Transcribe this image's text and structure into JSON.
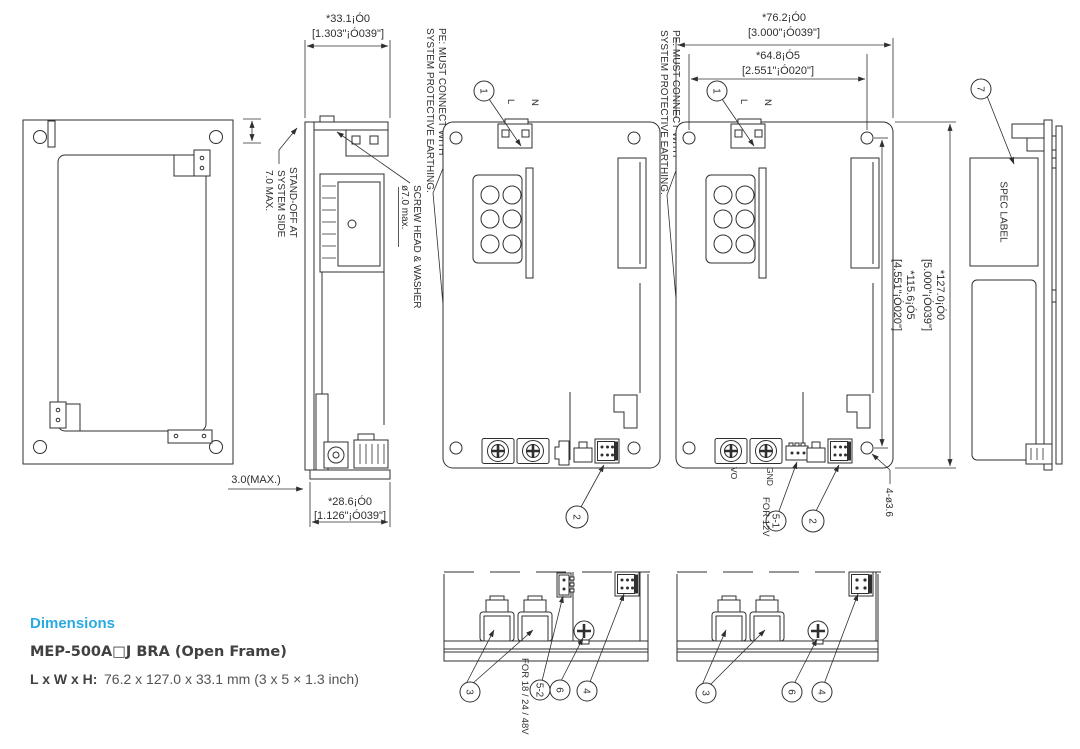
{
  "info": {
    "section_title": "Dimensions",
    "model_title": "MEP-500A□J BRA (Open Frame)",
    "lwh_label": "L x W x H:",
    "lwh_value": "76.2 x 127.0 x 33.1 mm (3 x 5 × 1.3 inch)"
  },
  "colors": {
    "accent": "#29abe2",
    "line": "#2f2f2f",
    "text_dark": "#414042"
  },
  "dims": {
    "depth_mm": "*33.1¡Ó0",
    "depth_in": "[1.303\"¡Ó039\"]",
    "width_mm": "*76.2¡Ó0",
    "width_in": "[3.000\"¡Ó039\"]",
    "hole_span_w_mm": "*64.8¡Ó5",
    "hole_span_w_in": "[2.551\"¡Ó020\"]",
    "height_mm": "*127.0¡Ó0",
    "height_in": "[5.000\"¡Ó039\"]",
    "hole_span_h_mm": "*115.6¡Ó5",
    "hole_span_h_in": "[4.551\"¡Ó020\"]",
    "base_mm": "*28.6¡Ó0",
    "base_in": "[1.126\"¡Ó039\"]",
    "pcb_clearance": "3.0(MAX.)",
    "mounting_holes": "4-ø3.6"
  },
  "notes": {
    "pe_line1": "PE: MUST CONNECT WITH",
    "pe_line2": "SYSTEM PROTECTIVE EARTHING.",
    "standoff_line1": "STAND-OFF AT",
    "standoff_line2": "SYSTEM SIDE",
    "standoff_line3": "7.0 MAX.",
    "screw_line1": "SCREW HEAD & WASHER",
    "screw_line2": "ø7.0 max.",
    "spec_label": "SPEC LABEL",
    "for_12v": "FOR 12V",
    "for_18_24_48v": "FOR 18 / 24 / 48V"
  },
  "terminals": {
    "l": "L",
    "n": "N",
    "vo": "VO",
    "gnd": "GND"
  },
  "callouts": {
    "n1": "1",
    "n2": "2",
    "n3": "3",
    "n4": "4",
    "n5_1": "5-1",
    "n5_2": "5-2",
    "n6": "6",
    "n7": "7"
  }
}
